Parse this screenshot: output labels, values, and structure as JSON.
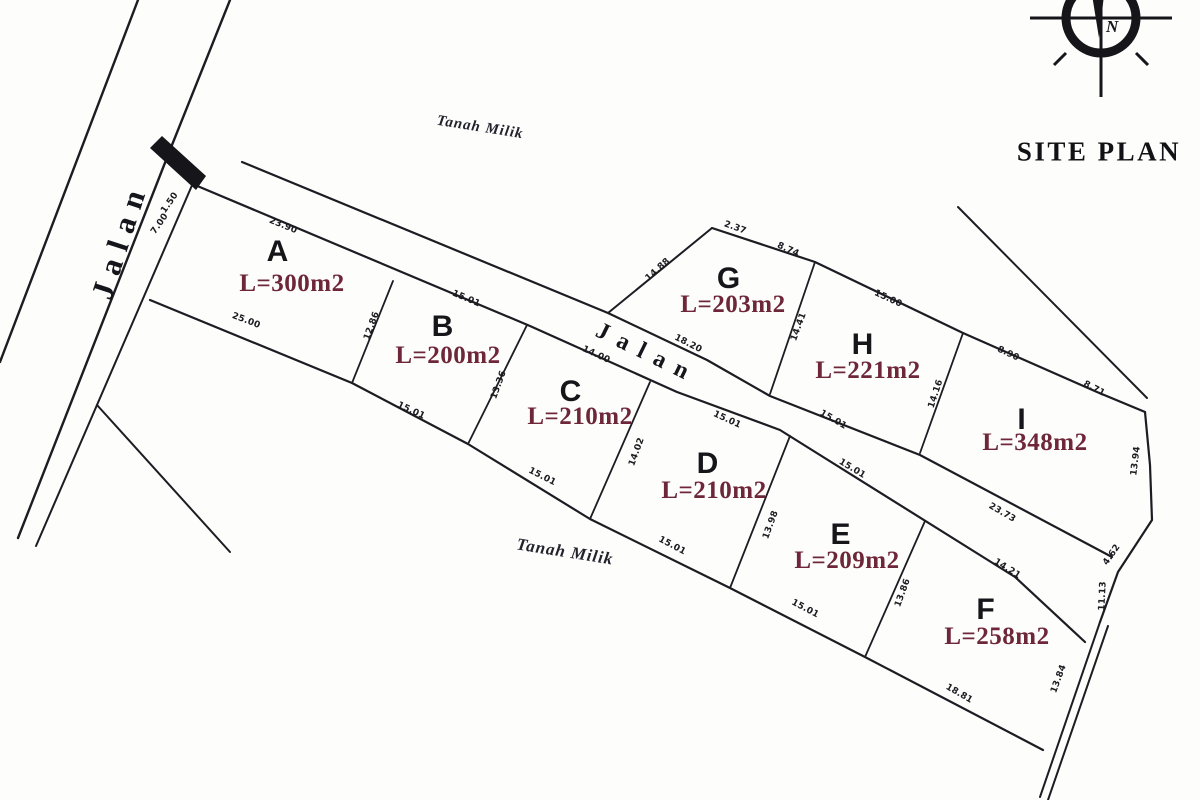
{
  "title": "SITE PLAN",
  "compass": {
    "label": "N"
  },
  "roads": {
    "left_label": "Jalan",
    "center_label": "Jalan"
  },
  "land_labels": {
    "top": "Tanah Milik",
    "bottom": "Tanah Milik"
  },
  "colors": {
    "ink": "#1c1c22",
    "area_text": "#6e2639"
  },
  "plots": [
    {
      "id": "A",
      "letter": "A",
      "area_label": "L=300m2"
    },
    {
      "id": "B",
      "letter": "B",
      "area_label": "L=200m2"
    },
    {
      "id": "C",
      "letter": "C",
      "area_label": "L=210m2"
    },
    {
      "id": "D",
      "letter": "D",
      "area_label": "L=210m2"
    },
    {
      "id": "E",
      "letter": "E",
      "area_label": "L=209m2"
    },
    {
      "id": "F",
      "letter": "F",
      "area_label": "L=258m2"
    },
    {
      "id": "G",
      "letter": "G",
      "area_label": "L=203m2"
    },
    {
      "id": "H",
      "letter": "H",
      "area_label": "L=221m2"
    },
    {
      "id": "I",
      "letter": "I",
      "area_label": "L=348m2"
    }
  ],
  "dimensions": [
    {
      "id": "a-top",
      "value": "23.90"
    },
    {
      "id": "b-top",
      "value": "15.01"
    },
    {
      "id": "c-top",
      "value": "14.00"
    },
    {
      "id": "d-top",
      "value": "15.01"
    },
    {
      "id": "e-top",
      "value": "15.01"
    },
    {
      "id": "f-top",
      "value": "14.21"
    },
    {
      "id": "g-bottom",
      "value": "18.20"
    },
    {
      "id": "h-bottom",
      "value": "15.01"
    },
    {
      "id": "i-bottom",
      "value": "23.73"
    },
    {
      "id": "g-top-1",
      "value": "2.37"
    },
    {
      "id": "g-top-2",
      "value": "8.74"
    },
    {
      "id": "g-left",
      "value": "14.88"
    },
    {
      "id": "gh-divider",
      "value": "14.41"
    },
    {
      "id": "h-top",
      "value": "15.00"
    },
    {
      "id": "hi-divider",
      "value": "14.16"
    },
    {
      "id": "i-top-1",
      "value": "8.90"
    },
    {
      "id": "i-top-2",
      "value": "8.71"
    },
    {
      "id": "i-right-1",
      "value": "13.94"
    },
    {
      "id": "i-right-2",
      "value": "4.62"
    },
    {
      "id": "i-right-3",
      "value": "11.13"
    },
    {
      "id": "f-right",
      "value": "13.84"
    },
    {
      "id": "a-bottom",
      "value": "25.00"
    },
    {
      "id": "b-bottom",
      "value": "15.01"
    },
    {
      "id": "c-bottom",
      "value": "15.01"
    },
    {
      "id": "d-bottom",
      "value": "15.01"
    },
    {
      "id": "e-bottom",
      "value": "15.01"
    },
    {
      "id": "f-bottom",
      "value": "18.81"
    },
    {
      "id": "ab-divider",
      "value": "12.86"
    },
    {
      "id": "bc-divider",
      "value": "13.36"
    },
    {
      "id": "cd-divider",
      "value": "14.02"
    },
    {
      "id": "de-divider",
      "value": "13.98"
    },
    {
      "id": "ef-divider",
      "value": "13.86"
    },
    {
      "id": "road-corner-1",
      "value": "1.50"
    },
    {
      "id": "road-corner-2",
      "value": "7.00"
    }
  ]
}
